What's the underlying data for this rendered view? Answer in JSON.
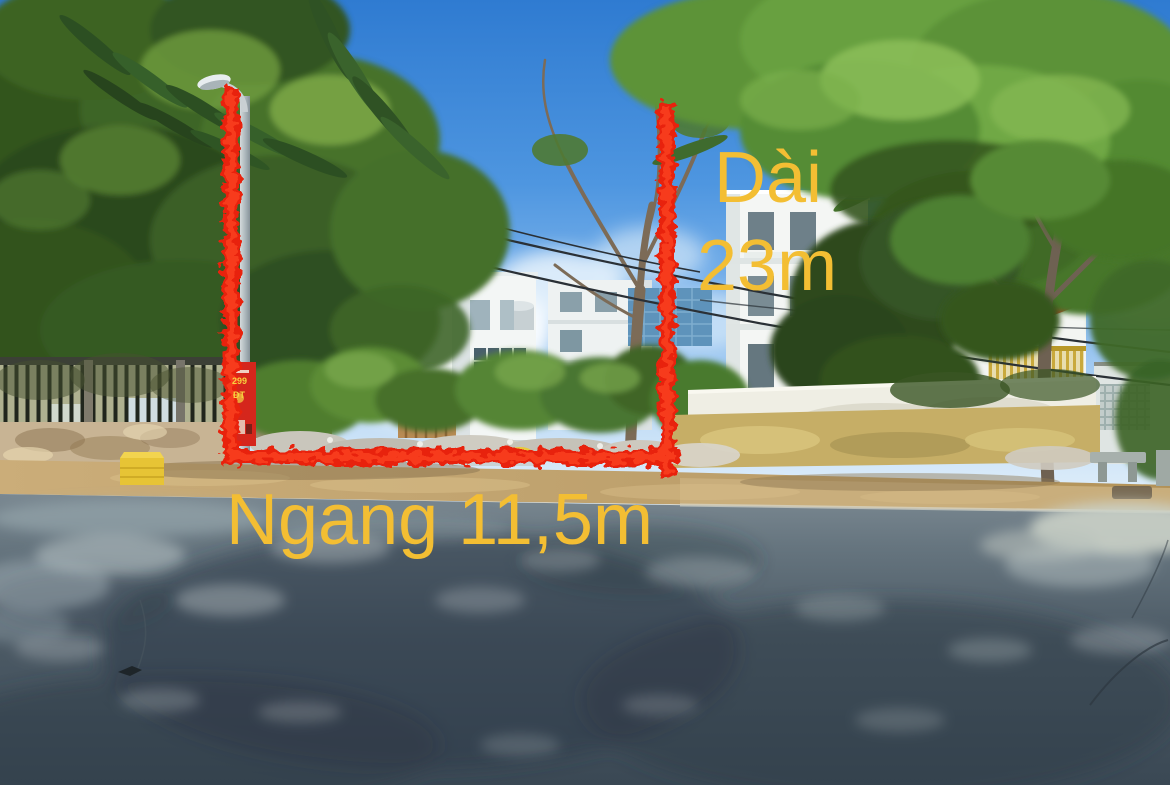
{
  "annotations": {
    "length_label": {
      "line1": "Dài",
      "line2": "23m"
    },
    "width_label": "Ngang 11,5m",
    "label_color": "#F3BE33",
    "boundary_color": "#FA2B13"
  },
  "pole_poster": {
    "line1": "299",
    "line2": "ĐT"
  },
  "palette": {
    "sky_top": "#2F7BD1",
    "sky_horizon": "#EAF4FB",
    "foliage_dark": "#2E4D26",
    "foliage_bright": "#6FA845",
    "building_white": "#F3F6F5",
    "road_asphalt": "#56656F",
    "dirt_sidewalk": "#C3A272",
    "dry_grass": "#C6AE66",
    "compound_wall": "#EFEEE4"
  }
}
